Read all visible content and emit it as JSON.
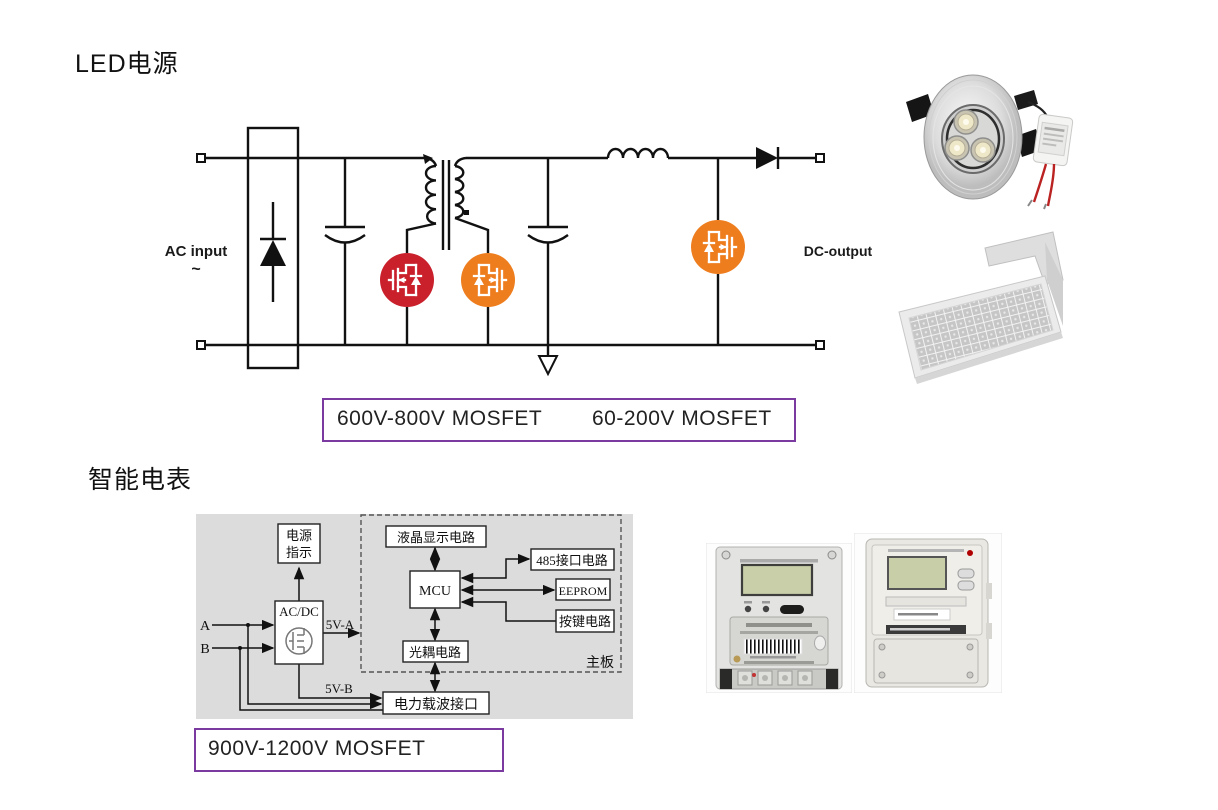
{
  "colors": {
    "mosfet_red": "#C9202C",
    "mosfet_orange": "#EE7D1E",
    "voltage_box_border": "#7B3AA0",
    "diagram_panel_gray": "#DCDCDC"
  },
  "led_section": {
    "title": "LED电源",
    "circuit": {
      "ac_input": "AC input",
      "ac_wave": "~",
      "dc_output": "DC-output"
    },
    "voltage_box": {
      "label_1": "600V-800V MOSFET",
      "label_2": "60-200V MOSFET"
    }
  },
  "meter_section": {
    "title": "智能电表",
    "diagram": {
      "power_indicator_1": "电源",
      "power_indicator_2": "指示",
      "acdc": "AC/DC",
      "input_a": "A",
      "input_b": "B",
      "rail_a": "5V-A",
      "rail_b": "5V-B",
      "lcd": "液晶显示电路",
      "mcu": "MCU",
      "rs485": "485接口电路",
      "eeprom": "EEPROM",
      "keys": "按键电路",
      "opto": "光耦电路",
      "mainboard": "主板",
      "plc": "电力载波接口"
    },
    "voltage_box": {
      "label": "900V-1200V MOSFET"
    }
  }
}
